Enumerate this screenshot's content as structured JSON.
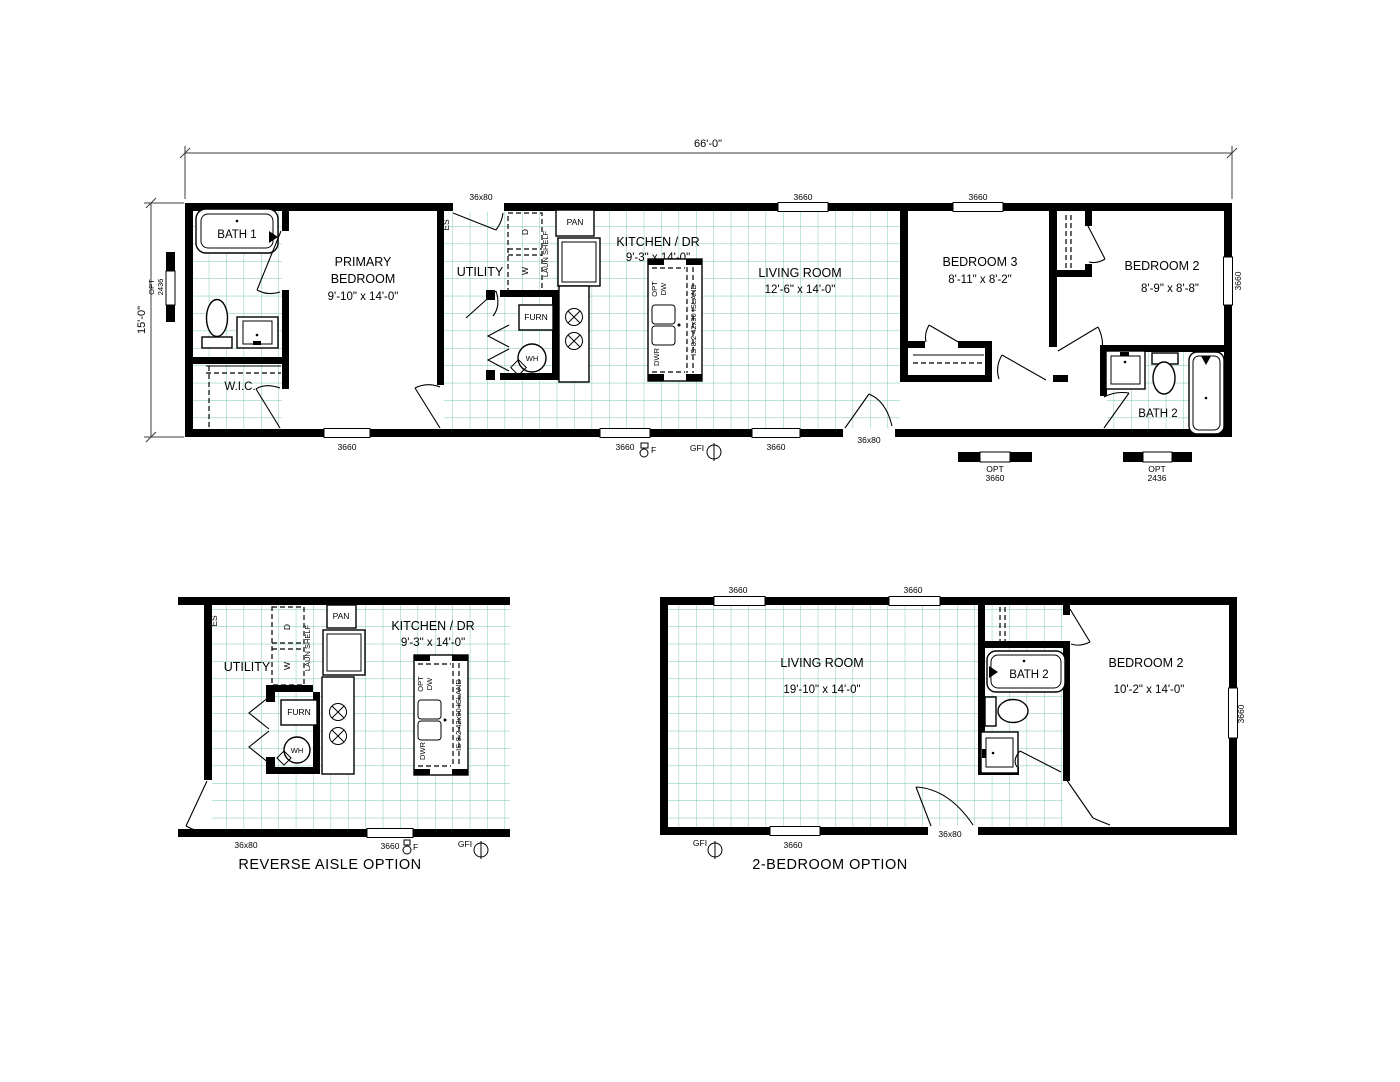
{
  "colors": {
    "wall": "#000000",
    "grid": "#74c7a8",
    "dim_line": "#3c3c3c",
    "text": "#000000",
    "background": "#ffffff"
  },
  "dims": {
    "width": "66'-0\"",
    "height": "15'-0\""
  },
  "labels": {
    "n3660": "3660",
    "n36x80": "36x80",
    "opt": "OPT",
    "n2436": "2436",
    "gfi": "GFI",
    "f": "F",
    "es": "ES",
    "pan": "PAN",
    "furn": "FURN",
    "wh": "WH",
    "washer": "W",
    "dryer": "D",
    "laun_shelf": "LAUN SHELF",
    "dw": "DW",
    "dwr": "DWR",
    "island": "IS-8.2 42x90 ISLAND"
  },
  "main": {
    "bath1": "BATH 1",
    "wic": "W.I.C.",
    "utility": "UTILITY",
    "bath2": "BATH 2",
    "primary_l1": "PRIMARY",
    "primary_l2": "BEDROOM",
    "primary_dims": "9'-10\" x 14'-0\"",
    "kitchen_l1": "KITCHEN / DR",
    "kitchen_dims": "9'-3\" x 14'-0\"",
    "living_l1": "LIVING ROOM",
    "living_dims": "12'-6\" x 14'-0\"",
    "bed3_l1": "BEDROOM 3",
    "bed3_dims": "8'-11\" x 8'-2\"",
    "bed2_l1": "BEDROOM 2",
    "bed2_dims": "8'-9\" x 8'-8\""
  },
  "reverse": {
    "caption": "REVERSE AISLE OPTION",
    "utility": "UTILITY",
    "kitchen_l1": "KITCHEN / DR",
    "kitchen_dims": "9'-3\" x 14'-0\""
  },
  "twobed": {
    "caption": "2-BEDROOM OPTION",
    "living_l1": "LIVING ROOM",
    "living_dims": "19'-10\" x 14'-0\"",
    "bed2_l1": "BEDROOM 2",
    "bed2_dims": "10'-2\" x 14'-0\"",
    "bath2": "BATH 2"
  }
}
